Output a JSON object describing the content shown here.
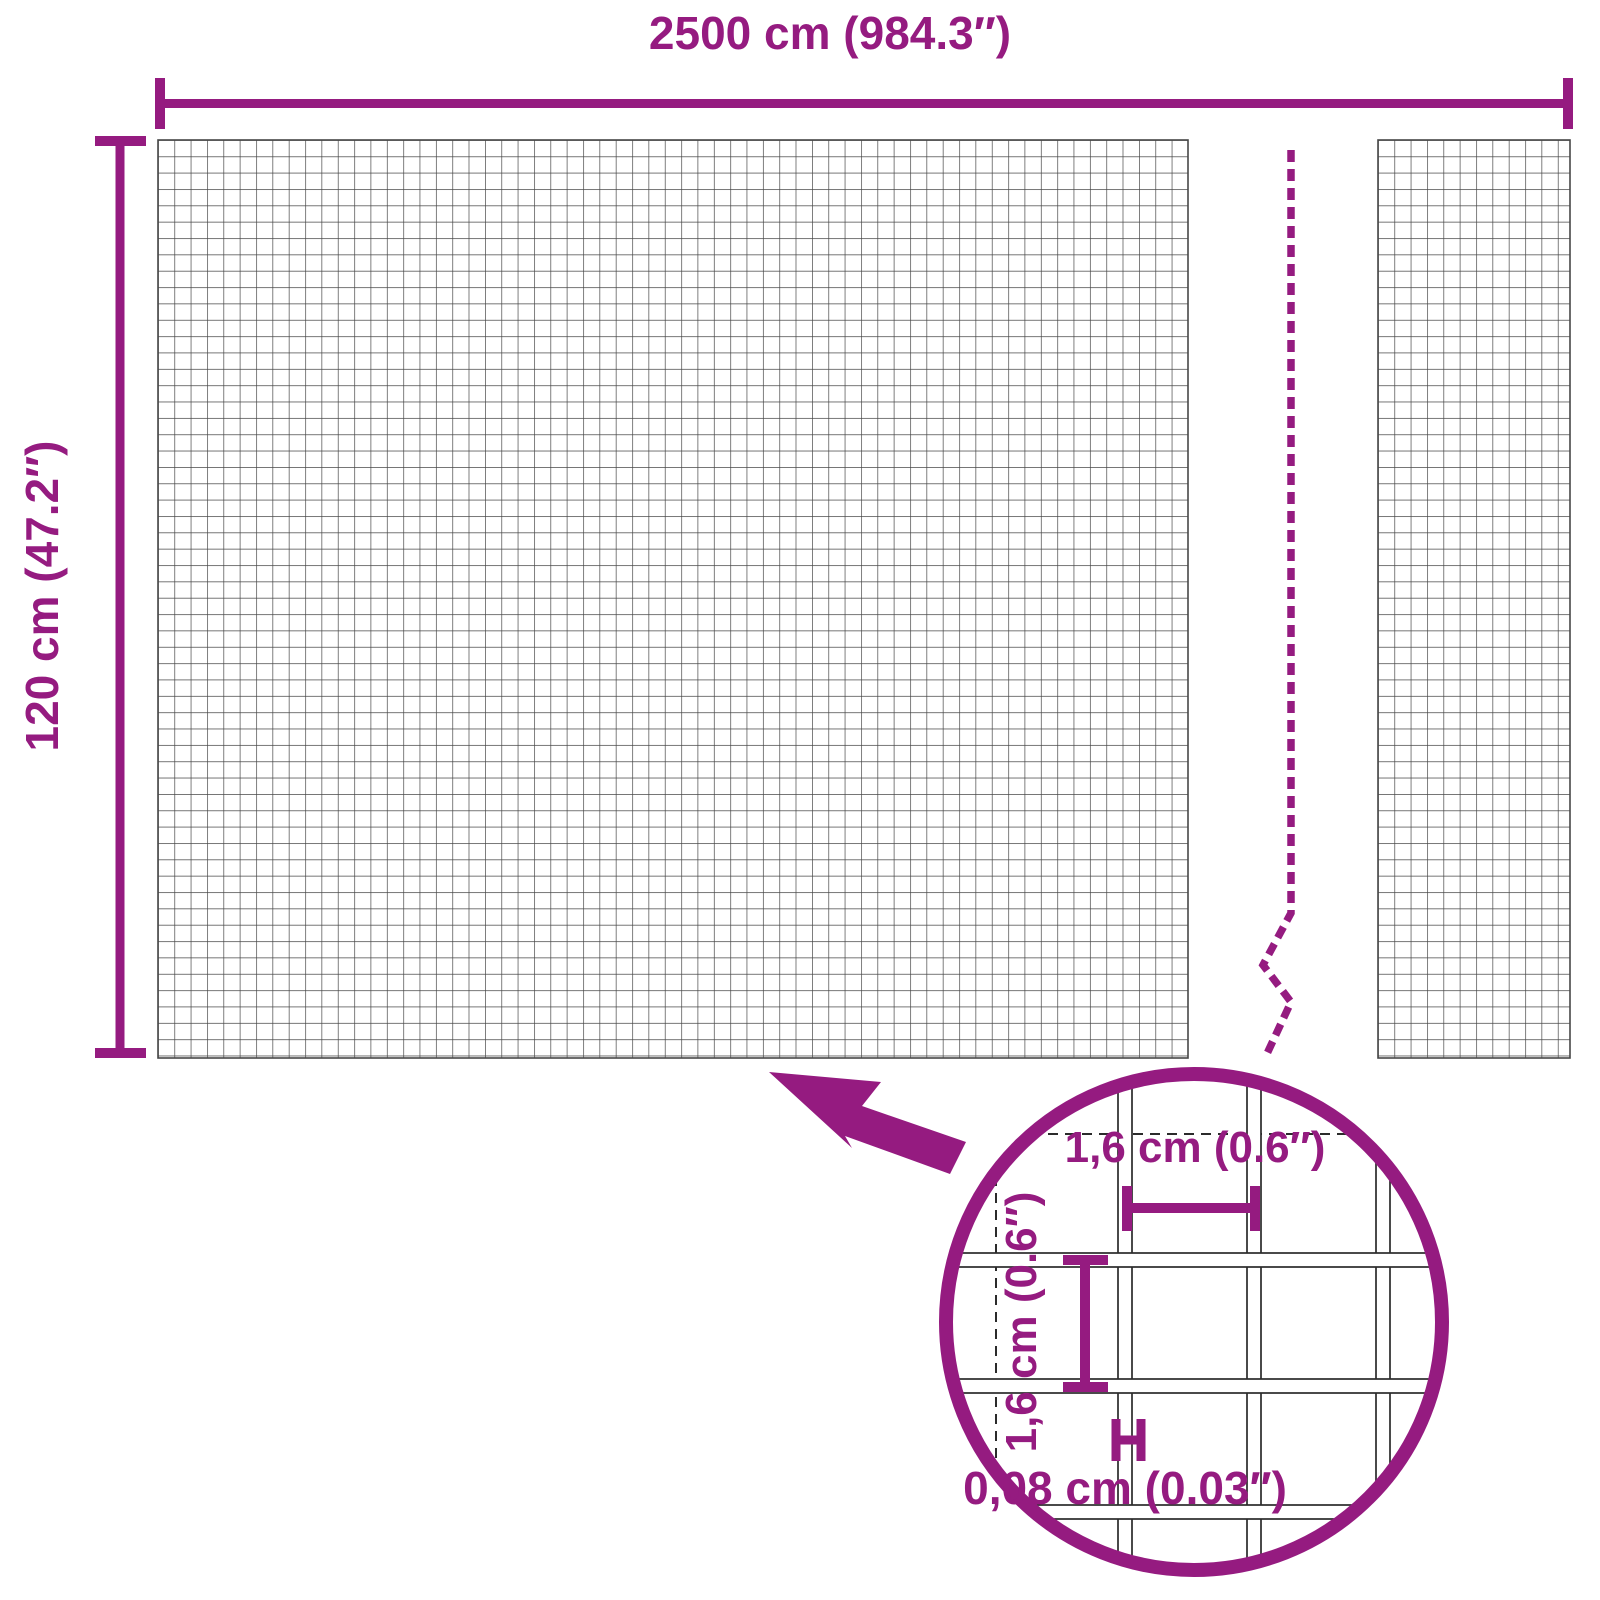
{
  "diagram": {
    "kind": "product-dimension-diagram",
    "panels": 2,
    "zoom_detail": "mesh close-up in magnifier circle"
  },
  "labels": {
    "total_width": "2500 cm (984.3″)",
    "total_height": "120 cm (47.2″)",
    "mesh_opening_width": "1,6 cm (0.6″)",
    "mesh_opening_height": "1,6 cm (0.6″)",
    "wire_thickness": "0,08 cm (0.03″)"
  },
  "colors": {
    "accent_purple": "#951b80",
    "mesh_line_gray": "#474747",
    "wire_outline_black": "#2b2b2b",
    "background": "#ffffff"
  },
  "icons": {
    "zoom_arrow": "thick purple arrow pointing up-left from magnifier circle to mesh",
    "magnifier_circle": "purple ring with enlarged mesh detail",
    "break_line": "purple dashed vertical break line with zigzag"
  }
}
